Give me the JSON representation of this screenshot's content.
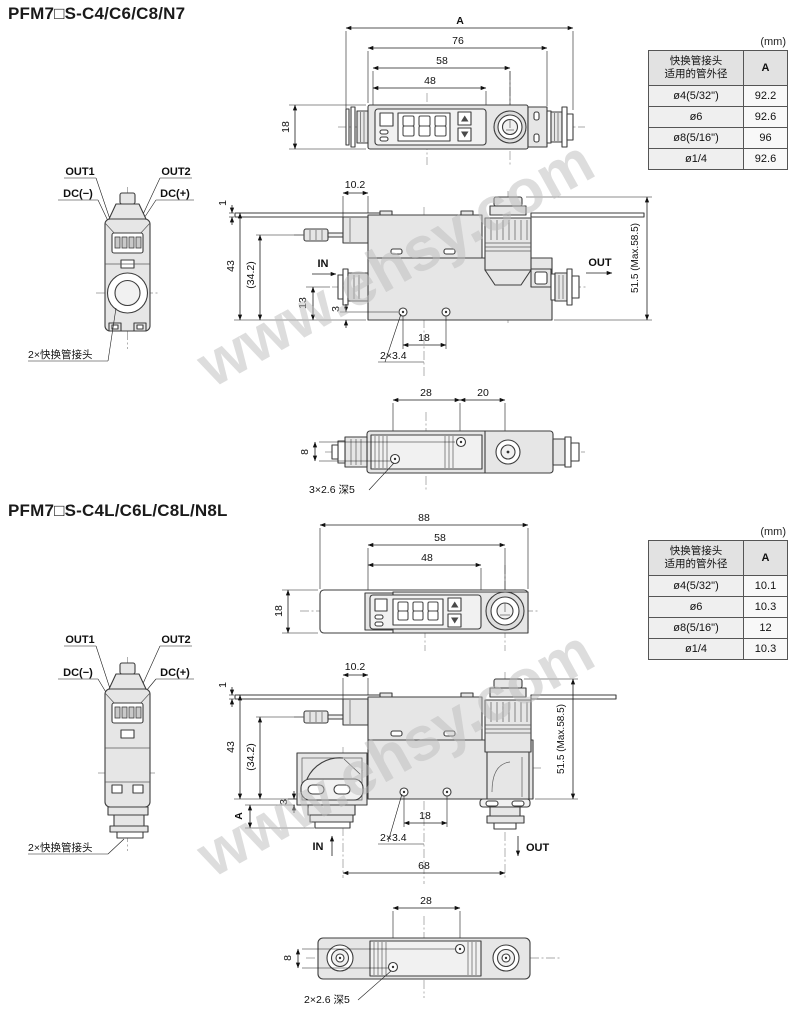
{
  "watermark": {
    "text": "www.ehsy.com"
  },
  "sections": [
    {
      "title": "PFM7□S-C4/C6/C8/N7",
      "table": {
        "unit": "(mm)",
        "header": {
          "line1": "快换管接头",
          "line2": "适用的管外径",
          "col_a": "A"
        },
        "rows": [
          {
            "od": "ø4(5/32\")",
            "a": "92.2"
          },
          {
            "od": "ø6",
            "a": "92.6"
          },
          {
            "od": "ø8(5/16\")",
            "a": "96"
          },
          {
            "od": "ø1/4",
            "a": "92.6"
          }
        ]
      },
      "front_view": {
        "dim_overall": "A",
        "dim_76": "76",
        "dim_58": "58",
        "dim_48": "48",
        "dim_height": "18"
      },
      "side_view": {
        "out1": "OUT1",
        "out2": "OUT2",
        "dc_minus": "DC(−)",
        "dc_plus": "DC(+)",
        "fitting_note": "2×快换管接头"
      },
      "elevation_view": {
        "dim_10_2": "10.2",
        "dim_1": "1",
        "dim_43": "43",
        "dim_34_2": "(34.2)",
        "dim_13": "13",
        "dim_3": "3",
        "dim_18": "18",
        "hole_note": "2×3.4",
        "flow_in": "IN",
        "flow_out": "OUT",
        "dim_height": "51.5 (Max.58.5)"
      },
      "bottom_view": {
        "dim_28": "28",
        "dim_20": "20",
        "dim_8": "8",
        "hole_note": "3×2.6 深5"
      }
    },
    {
      "title": "PFM7□S-C4L/C6L/C8L/N8L",
      "table": {
        "unit": "(mm)",
        "header": {
          "line1": "快换管接头",
          "line2": "适用的管外径",
          "col_a": "A"
        },
        "rows": [
          {
            "od": "ø4(5/32\")",
            "a": "10.1"
          },
          {
            "od": "ø6",
            "a": "10.3"
          },
          {
            "od": "ø8(5/16\")",
            "a": "12"
          },
          {
            "od": "ø1/4",
            "a": "10.3"
          }
        ]
      },
      "front_view": {
        "dim_overall": "88",
        "dim_58": "58",
        "dim_48": "48",
        "dim_height": "18"
      },
      "side_view": {
        "out1": "OUT1",
        "out2": "OUT2",
        "dc_minus": "DC(−)",
        "dc_plus": "DC(+)",
        "fitting_note": "2×快换管接头"
      },
      "elevation_view": {
        "dim_10_2": "10.2",
        "dim_1": "1",
        "dim_43": "43",
        "dim_34_2": "(34.2)",
        "dim_3": "3",
        "dim_18": "18",
        "dim_a": "A",
        "dim_68": "68",
        "hole_note": "2×3.4",
        "flow_in": "IN",
        "flow_out": "OUT",
        "dim_height": "51.5 (Max.58.5)"
      },
      "bottom_view": {
        "dim_28": "28",
        "dim_8": "8",
        "hole_note": "2×2.6 深5"
      }
    }
  ]
}
